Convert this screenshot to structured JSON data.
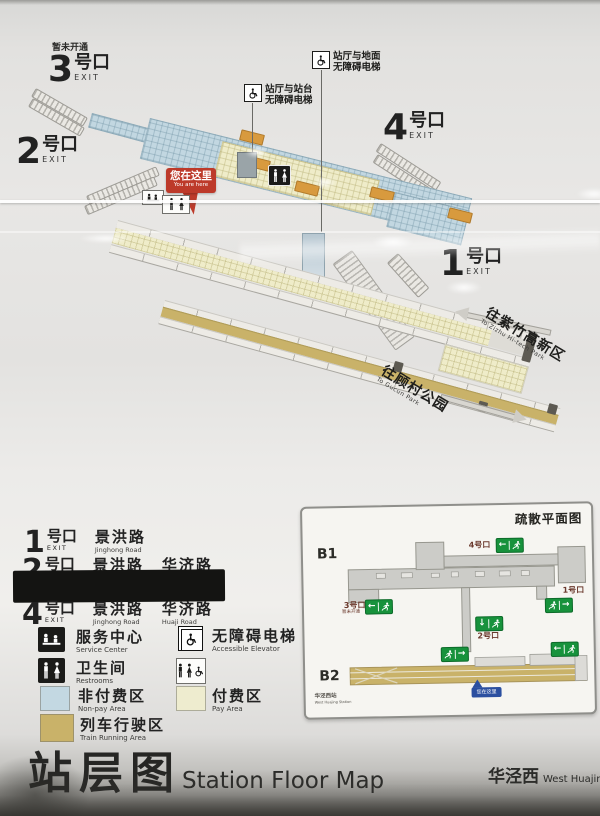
{
  "colors": {
    "marker_red": "#bd3a2a",
    "exit_green": "#17923c",
    "gate_orange": "#d89a3e",
    "inset_marker_blue": "#2b4fa0",
    "non_pay_blue": "#c3d8e2",
    "pay_yellow": "#eeeccf",
    "train_tan": "#c9b269"
  },
  "map": {
    "not_open": "暂未开通",
    "exit3": {
      "num": "3",
      "suffix": "号口",
      "exit": "EXIT"
    },
    "exit2": {
      "num": "2",
      "suffix": "号口",
      "exit": "EXIT"
    },
    "exit4": {
      "num": "4",
      "suffix": "号口",
      "exit": "EXIT"
    },
    "exit1": {
      "num": "1",
      "suffix": "号口",
      "exit": "EXIT"
    },
    "elevator_ground": {
      "line1": "站厅与地面",
      "line2": "无障碍电梯"
    },
    "elevator_platform": {
      "line1": "站厅与站台",
      "line2": "无障碍电梯"
    },
    "you_are_here": {
      "zh": "您在这里",
      "en": "You are here"
    },
    "dir_left": {
      "zh": "往紫竹高新区",
      "en": "To Zizhu Hi-tech Park"
    },
    "dir_right": {
      "zh": "往顾村公园",
      "en": "To Gucun Park"
    }
  },
  "legend": {
    "rows": [
      {
        "num": "1",
        "suffix": "号口",
        "exit": "EXIT",
        "road1_zh": "景洪路",
        "road1_en": "Jinghong Road"
      },
      {
        "num": "2",
        "suffix": "号口",
        "exit": "EXIT",
        "road1_zh": "景洪路",
        "road1_en": "Jinghong Road",
        "road2_zh": "华济路",
        "road2_en": "Huaji Road"
      },
      {
        "num": "4",
        "suffix": "号口",
        "exit": "EXIT",
        "road1_zh": "景洪路",
        "road1_en": "Jinghong Road",
        "road2_zh": "华济路",
        "road2_en": "Huaji Road"
      }
    ],
    "service": {
      "zh": "服务中心",
      "en": "Service Center"
    },
    "elevator": {
      "zh": "无障碍电梯",
      "en": "Accessible Elevator"
    },
    "restroom": {
      "zh": "卫生间",
      "en": "Restrooms"
    },
    "non_pay": {
      "zh": "非付费区",
      "en": "Non-pay Area",
      "color": "#c3d8e2"
    },
    "pay": {
      "zh": "付费区",
      "en": "Pay Area",
      "color": "#eeeccf"
    },
    "train": {
      "zh": "列车行驶区",
      "en": "Train Running Area",
      "color": "#c9b269"
    }
  },
  "inset": {
    "title": "疏散平面图",
    "b1": "B1",
    "b2": "B2",
    "exit4": "4号口",
    "exit3": "3号口",
    "exit3_note": "暂未开通",
    "exit1": "1号口",
    "exit2": "2号口",
    "marker": "您在这里",
    "station_zh": "华泾西站",
    "station_en": "West Huajing Station"
  },
  "footer": {
    "title_zh": "站层图",
    "title_en": "Station Floor Map",
    "station_zh": "华泾西",
    "station_en": "West Huajing"
  }
}
